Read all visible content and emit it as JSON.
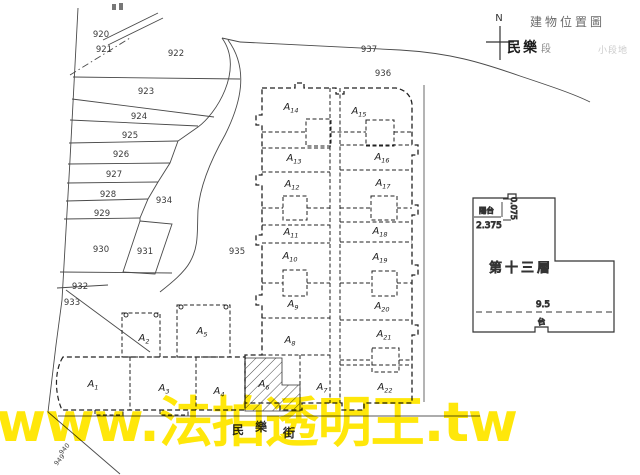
{
  "header": {
    "north_label": "N",
    "title": "建物位置圖",
    "section_name": "民樂",
    "section_suffix": "段",
    "faint_note": "小段地"
  },
  "parcels": [
    "920",
    "921",
    "922",
    "923",
    "924",
    "925",
    "926",
    "927",
    "928",
    "929",
    "930",
    "931",
    "932",
    "933",
    "934",
    "935",
    "936",
    "937"
  ],
  "units": {
    "base": "A",
    "subs": [
      "1",
      "2",
      "3",
      "4",
      "5",
      "6",
      "7",
      "8",
      "9",
      "10",
      "11",
      "12",
      "13",
      "14",
      "15",
      "16",
      "17",
      "18",
      "19",
      "20",
      "21",
      "22"
    ]
  },
  "floor13": {
    "label": "第十三層",
    "dim_left": "2.375",
    "dim_small_vertical": "0.075",
    "dim_bottom": "9.5",
    "balcony_label": "陽台",
    "balcony_mark": "台"
  },
  "street": {
    "chars": [
      "民",
      "樂",
      "街"
    ]
  },
  "margin_scribbles": [
    "940",
    "949"
  ],
  "watermark": {
    "text": "www.法拍透明王.tw",
    "color": "#ffe70a"
  },
  "colors": {
    "ink": "#333333",
    "building_dash": "#222222",
    "faint_note": "#cccccc"
  }
}
